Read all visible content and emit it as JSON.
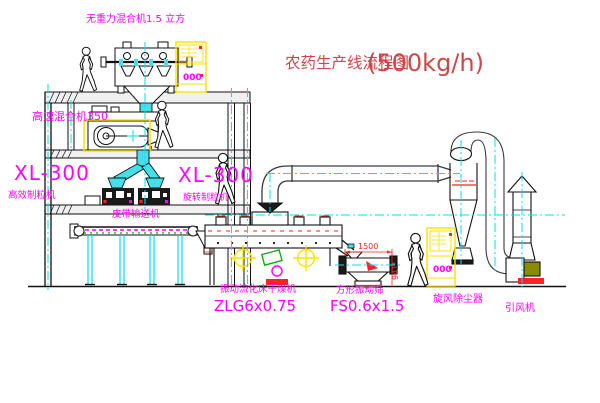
{
  "title": {
    "name": "农药生产线流程图",
    "capacity": "(500kg/h)"
  },
  "labels": {
    "top_mixer": "无重力混合机1.5 立方",
    "high_speed_mixer": "高速混合机350",
    "granulator_left_model": "XL-300",
    "granulator_left_name": "高效制粒机",
    "granulator_right_model": "XL-300",
    "granulator_right_name": "旋转制粒机",
    "belt_conveyor": "皮带输送机",
    "dryer_name": "振动流化床干燥机",
    "dryer_model": "ZLG6x0.75",
    "sieve_name": "方形振动筛",
    "sieve_model": "FS0.6x1.5",
    "cyclone": "旋风除尘器",
    "fan": "引风机"
  },
  "dimensions": {
    "sieve_width": "1500",
    "sieve_height": "941"
  },
  "control_panel": {
    "display_value": "000"
  },
  "colors": {
    "label_magenta": "#FF00FF",
    "title_red": "#CC4848",
    "cabinet_yellow": "#FFE000",
    "centerline_cyan": "#00E0EE",
    "chute_cyan": "#45DFEA",
    "accent_green": "#00AA00",
    "alert_red": "#FF2222"
  }
}
